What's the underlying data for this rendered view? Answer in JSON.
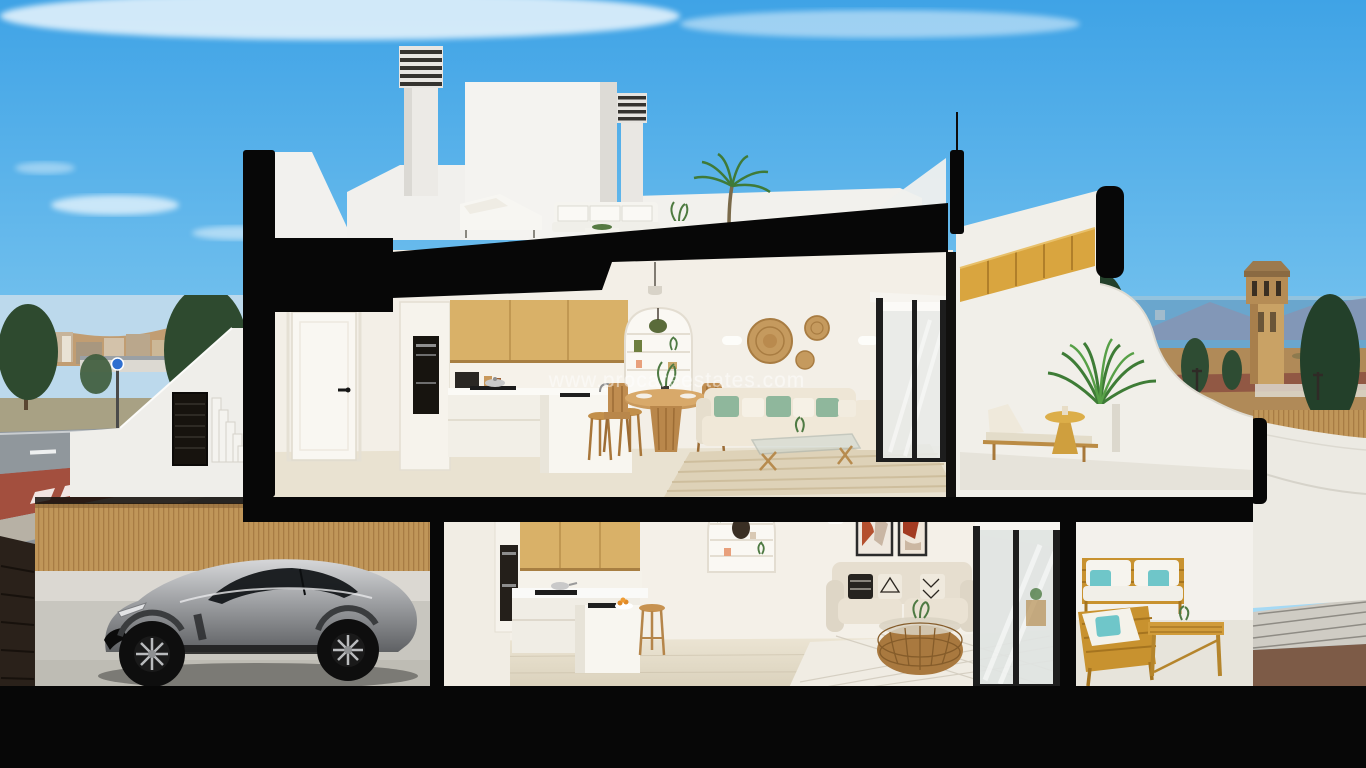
{
  "watermark": {
    "text": "www.procareestates.com"
  },
  "colors": {
    "sky_top": "#3fa3e6",
    "sky_mid": "#7cc6ef",
    "sky_bottom": "#c3e7f8",
    "cut_black": "#070707",
    "wall_white": "#f2f1ec",
    "interior_wall": "#f3efe7",
    "floor_beige": "#e9e2d1",
    "wood_cabinet": "#d9b168",
    "wood_stair": "#d9a53f",
    "fence_wood": "#c09659",
    "car_silver": "#a9abae",
    "teal_cushion": "#6fc6c9",
    "sage_cushion": "#8fb79c",
    "terracotta_art": "#b4502f",
    "sea_blue": "#6aa6cd",
    "town_hill_tan": "#c19a6b",
    "road_gray": "#90979c",
    "red_pavement": "#a34f3e",
    "gravel_brown": "#7d5b47",
    "patio_wood": "#c8922f"
  }
}
